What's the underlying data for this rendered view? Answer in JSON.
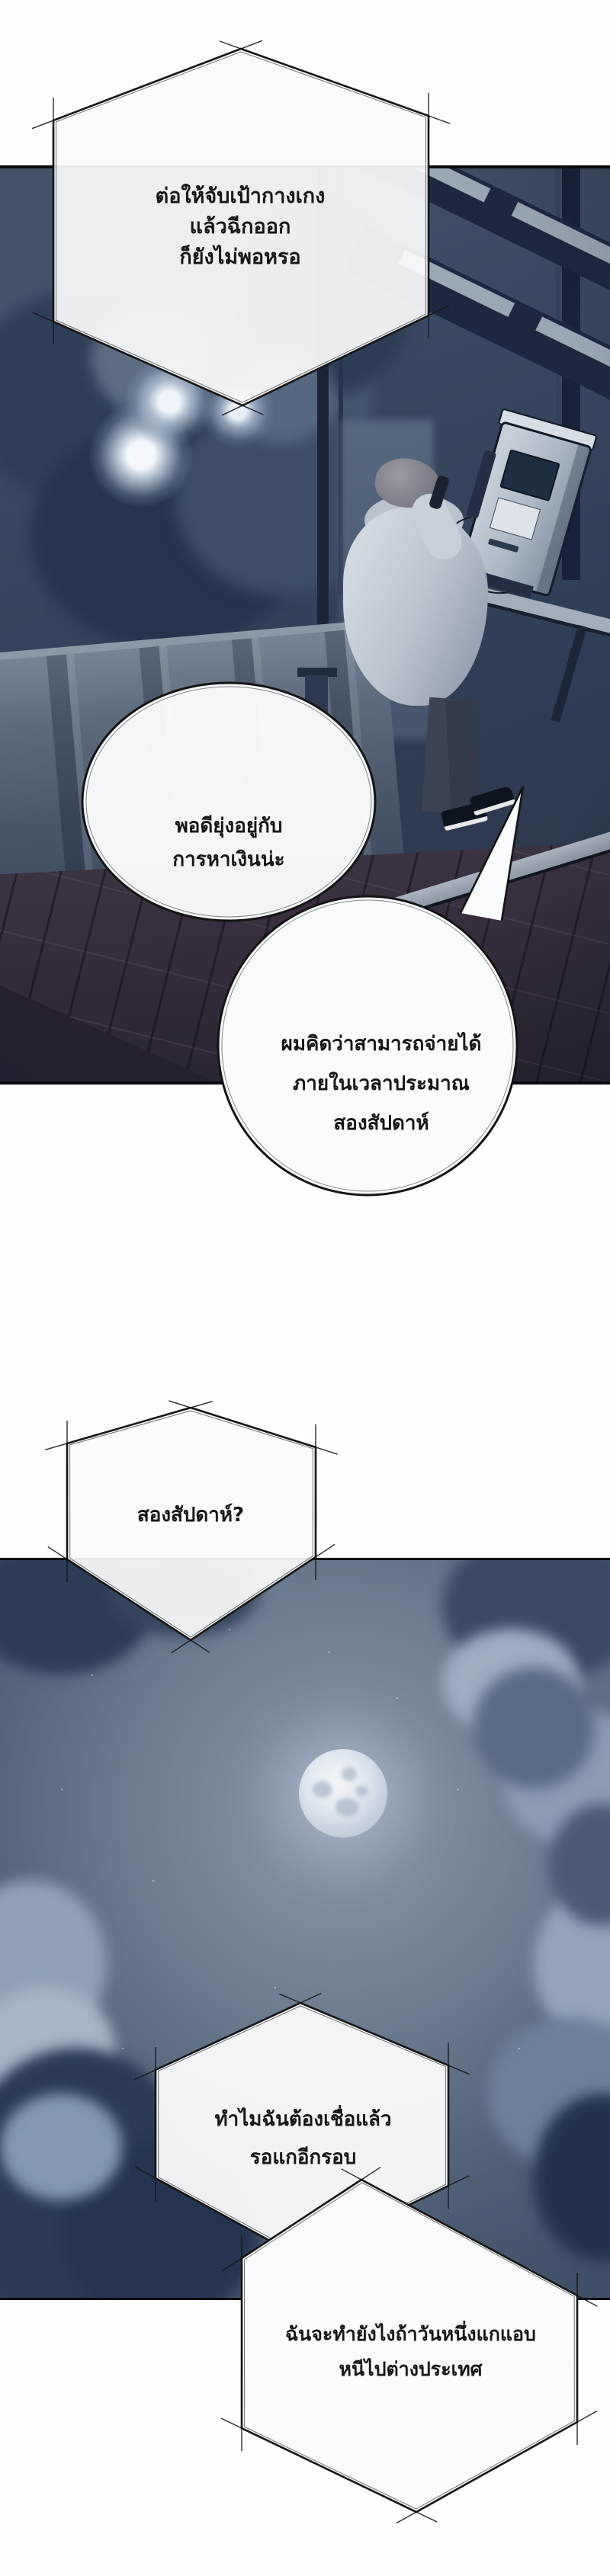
{
  "page": {
    "type": "webtoon-comic-page",
    "language": "th",
    "colors": {
      "ink": "#141414",
      "page_background": "#ffffff",
      "panel_night_blue": "#33425a",
      "deck_wood": "#362e3d",
      "moon": "#e9eef5",
      "bubble_fill": "#fafbfc"
    }
  },
  "speech": {
    "bubble1": {
      "shape": "hexagon",
      "lines": [
        "ต่อให้จับเป้ากางเกง",
        "แล้วฉีกออก",
        "ก็ยังไม่พอหรอ"
      ]
    },
    "bubble2": {
      "shape": "circle",
      "lines": [
        "พอดียุ่งอยู่กับ",
        "การหาเงินน่ะ"
      ]
    },
    "bubble3": {
      "shape": "circle",
      "lines": [
        "ผมคิดว่าสามารถจ่ายได้",
        "ภายในเวลาประมาณ",
        "สองสัปดาห์"
      ]
    },
    "bubble4": {
      "shape": "hexagon",
      "lines": [
        "สองสัปดาห์?"
      ]
    },
    "bubble5": {
      "shape": "hexagon",
      "lines": [
        "ทำไมฉันต้องเชื่อแล้ว",
        "รอแกอีกรอบ"
      ]
    },
    "bubble6": {
      "shape": "hexagon",
      "lines": [
        "ฉันจะทำยังไงถ้าวันหนึ่งแกแอบ",
        "หนีไปต่างประเทศ"
      ]
    }
  }
}
